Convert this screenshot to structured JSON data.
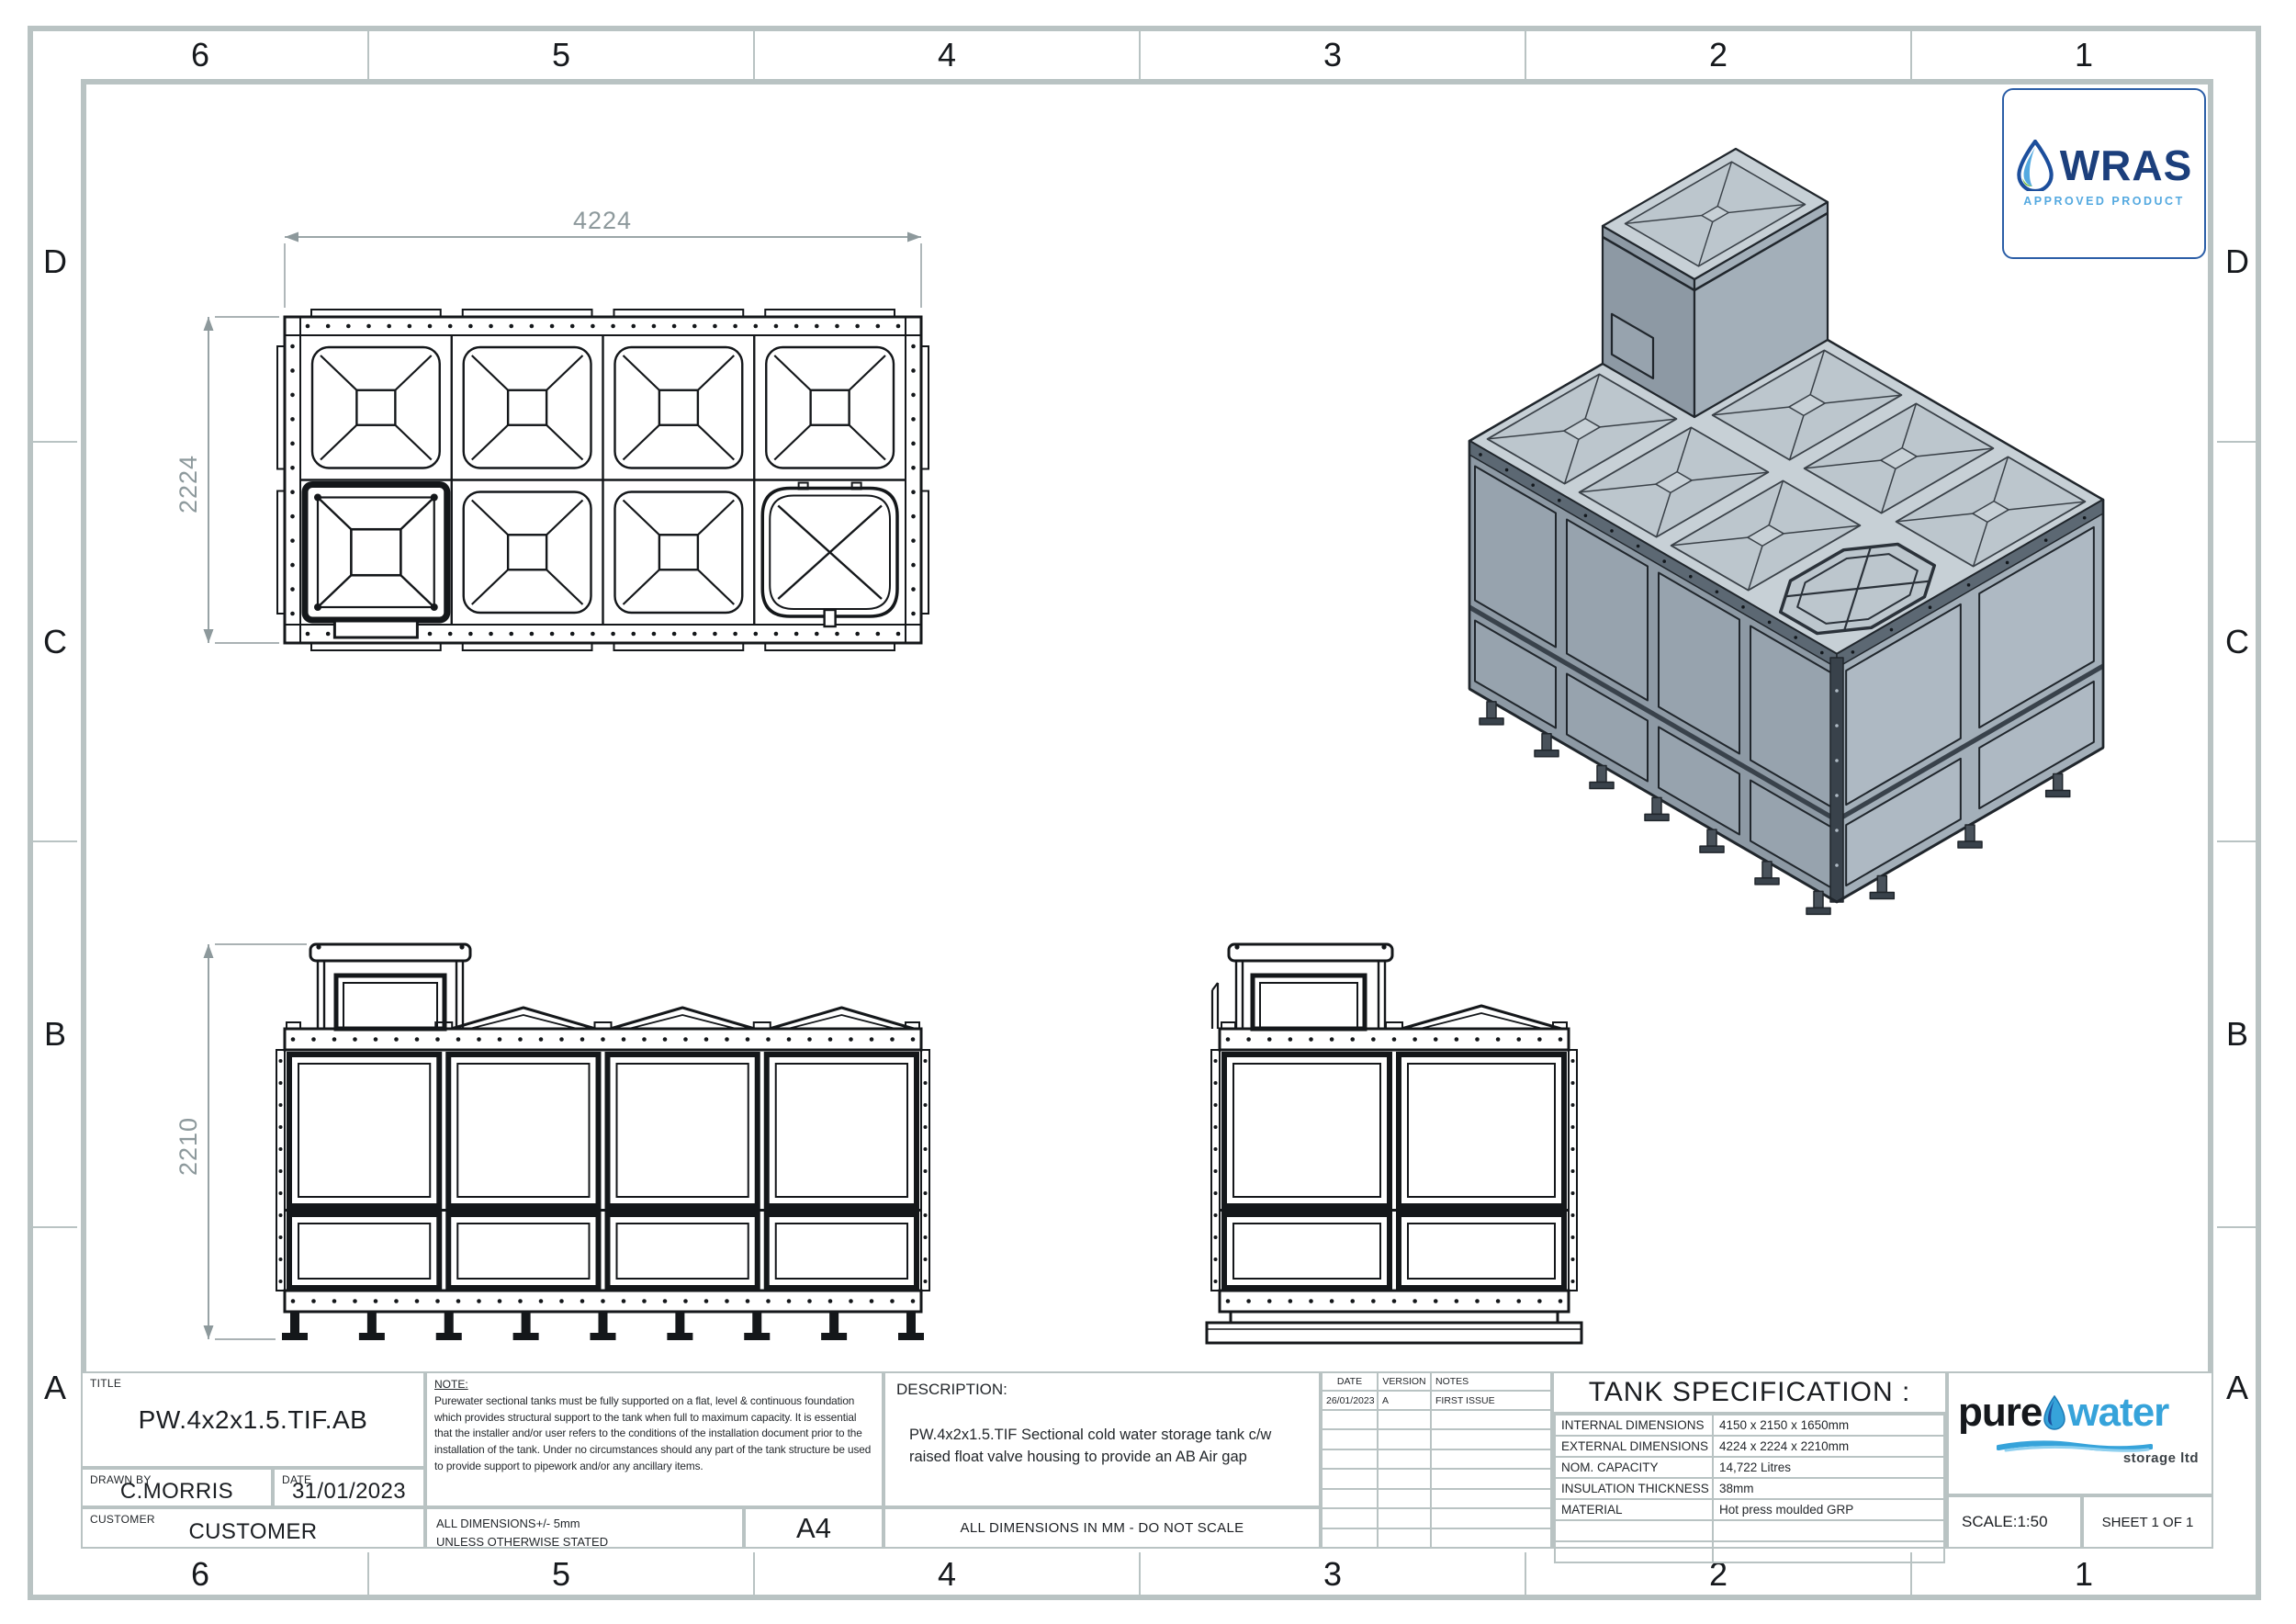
{
  "sheet": {
    "grid": {
      "cols": [
        "6",
        "5",
        "4",
        "3",
        "2",
        "1"
      ],
      "rows": [
        "D",
        "C",
        "B",
        "A"
      ]
    },
    "views": {
      "plan": {
        "width_dim": "4224",
        "height_dim": "2224"
      },
      "front": {
        "height_dim": "2210"
      }
    },
    "wras": {
      "name": "WRAS",
      "subtitle": "APPROVED PRODUCT"
    },
    "logo": {
      "word1": "pure",
      "word2": "water",
      "tagline": "storage ltd"
    },
    "title_block": {
      "title_label": "TITLE",
      "title": "PW.4x2x1.5.TIF.AB",
      "drawn_by_label": "DRAWN BY",
      "drawn_by": "C.MORRIS",
      "date_label": "DATE",
      "date": "31/01/2023",
      "customer_label": "CUSTOMER",
      "customer": "CUSTOMER",
      "note_label": "NOTE:",
      "note_text": "Purewater sectional tanks must be fully supported on a flat, level & continuous foundation which provides structural support to the tank when full to maximum capacity. It is essential that the installer and/or user refers to the conditions of the installation document prior to the installation of the tank. Under no circumstances should any part of the tank structure be used to provide support to pipework and/or any ancillary items.",
      "tolerance_line1": "ALL DIMENSIONS+/- 5mm",
      "tolerance_line2": "UNLESS OTHERWISE STATED",
      "paper_size": "A4",
      "description_label": "DESCRIPTION:",
      "description": "PW.4x2x1.5.TIF Sectional cold water storage tank c/w raised float valve housing to provide an AB Air gap",
      "dimensions_note": "ALL DIMENSIONS IN MM - DO NOT SCALE",
      "scale": "SCALE:1:50",
      "sheet": "SHEET 1 OF 1"
    },
    "revisions": {
      "headers": [
        "DATE",
        "VERSION",
        "NOTES"
      ],
      "rows": [
        {
          "date": "26/01/2023",
          "version": "A",
          "notes": "FIRST ISSUE"
        }
      ]
    },
    "specification": {
      "title": "TANK SPECIFICATION :",
      "rows": [
        {
          "label": "INTERNAL DIMENSIONS",
          "value": "4150 x 2150 x 1650mm"
        },
        {
          "label": "EXTERNAL DIMENSIONS",
          "value": "4224 x 2224 x 2210mm"
        },
        {
          "label": "NOM. CAPACITY",
          "value": "14,722 Litres"
        },
        {
          "label": "INSULATION THICKNESS",
          "value": "38mm"
        },
        {
          "label": "MATERIAL",
          "value": "Hot press moulded GRP"
        }
      ]
    },
    "colors": {
      "frame": "#b9c3c3",
      "ink": "#14171a",
      "dim_gray": "#8d999c",
      "wras_navy": "#1c3f7c",
      "wras_blue": "#54a9e0",
      "logo_blue": "#36a3da",
      "iso_top": "#c7d0d6",
      "iso_left": "#8d99a4",
      "iso_right": "#a3afb9"
    }
  }
}
